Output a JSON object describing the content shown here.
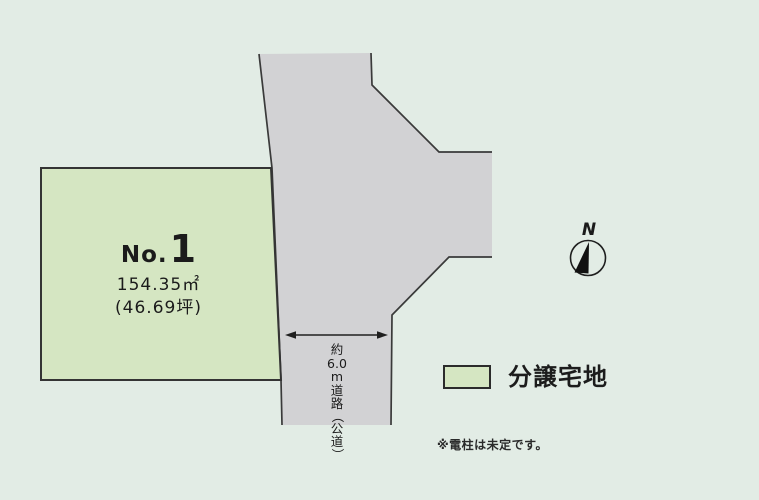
{
  "colors": {
    "background": "#e2ece5",
    "lot_fill": "#d5e6c2",
    "road_fill": "#d2d2d4",
    "stroke": "#3a3a3a"
  },
  "map": {
    "lot": {
      "no_prefix": "No.",
      "no_value": "1",
      "area_m2": "154.35㎡",
      "area_tsubo": "(46.69坪)"
    },
    "road": {
      "width_label_chars": [
        "約",
        "6.0",
        "m",
        "道",
        "路",
        "（",
        "公",
        "道",
        "）"
      ]
    },
    "north_label": "N"
  },
  "legend": {
    "label": "分譲宅地"
  },
  "note": "※電柱は未定です。"
}
